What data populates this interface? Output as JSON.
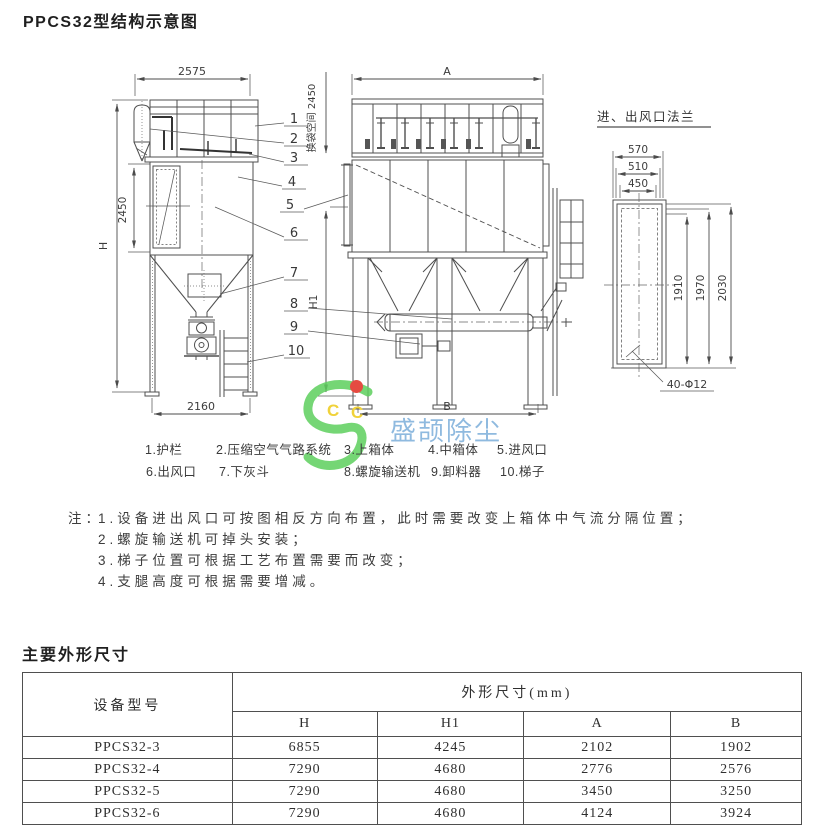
{
  "page": {
    "title": "PPCS32型结构示意图",
    "section_dimensions_title": "主要外形尺寸"
  },
  "drawing": {
    "left_view": {
      "dim_width_top": "2575",
      "dim_height": "H",
      "dim_body_height": "2450",
      "dim_width_bottom": "2160"
    },
    "middle_view": {
      "dim_width_top": "A",
      "dim_bag_space": "换袋空间 2450",
      "dim_h1": "H1",
      "dim_width_bottom": "B"
    },
    "flange_view": {
      "title": "进、出风口法兰",
      "dim_outer": "570",
      "dim_mid": "510",
      "dim_inner": "450",
      "dim_h1": "1910",
      "dim_h2": "1970",
      "dim_h3": "2030",
      "bolt_holes": "40-Φ12"
    },
    "part_numbers": [
      "1",
      "2",
      "3",
      "4",
      "5",
      "6",
      "7",
      "8",
      "9",
      "10"
    ]
  },
  "legend": {
    "items": [
      "1.护栏",
      "2.压缩空气气路系统",
      "3.上箱体",
      "4.中箱体",
      "5.进风口",
      "6.出风口",
      "7.下灰斗",
      "8.螺旋输送机",
      "9.卸料器",
      "10.梯子"
    ]
  },
  "notes": {
    "label": "注：",
    "items": [
      "1.设备进出风口可按图相反方向布置，此时需要改变上箱体中气流分隔位置；",
      "2.螺旋输送机可掉头安装；",
      "3.梯子位置可根据工艺布置需要而改变；",
      "4.支腿高度可根据需要增减。"
    ]
  },
  "watermark": {
    "brand": "盛颉除尘",
    "letter1": "C",
    "letter2": "C"
  },
  "table": {
    "model_header": "设备型号",
    "group_header": "外形尺寸(mm)",
    "columns": [
      "H",
      "H1",
      "A",
      "B"
    ],
    "rows": [
      {
        "model": "PPCS32-3",
        "values": [
          "6855",
          "4245",
          "2102",
          "1902"
        ]
      },
      {
        "model": "PPCS32-4",
        "values": [
          "7290",
          "4680",
          "2776",
          "2576"
        ]
      },
      {
        "model": "PPCS32-5",
        "values": [
          "7290",
          "4680",
          "3450",
          "3250"
        ]
      },
      {
        "model": "PPCS32-6",
        "values": [
          "7290",
          "4680",
          "4124",
          "3924"
        ]
      }
    ]
  }
}
